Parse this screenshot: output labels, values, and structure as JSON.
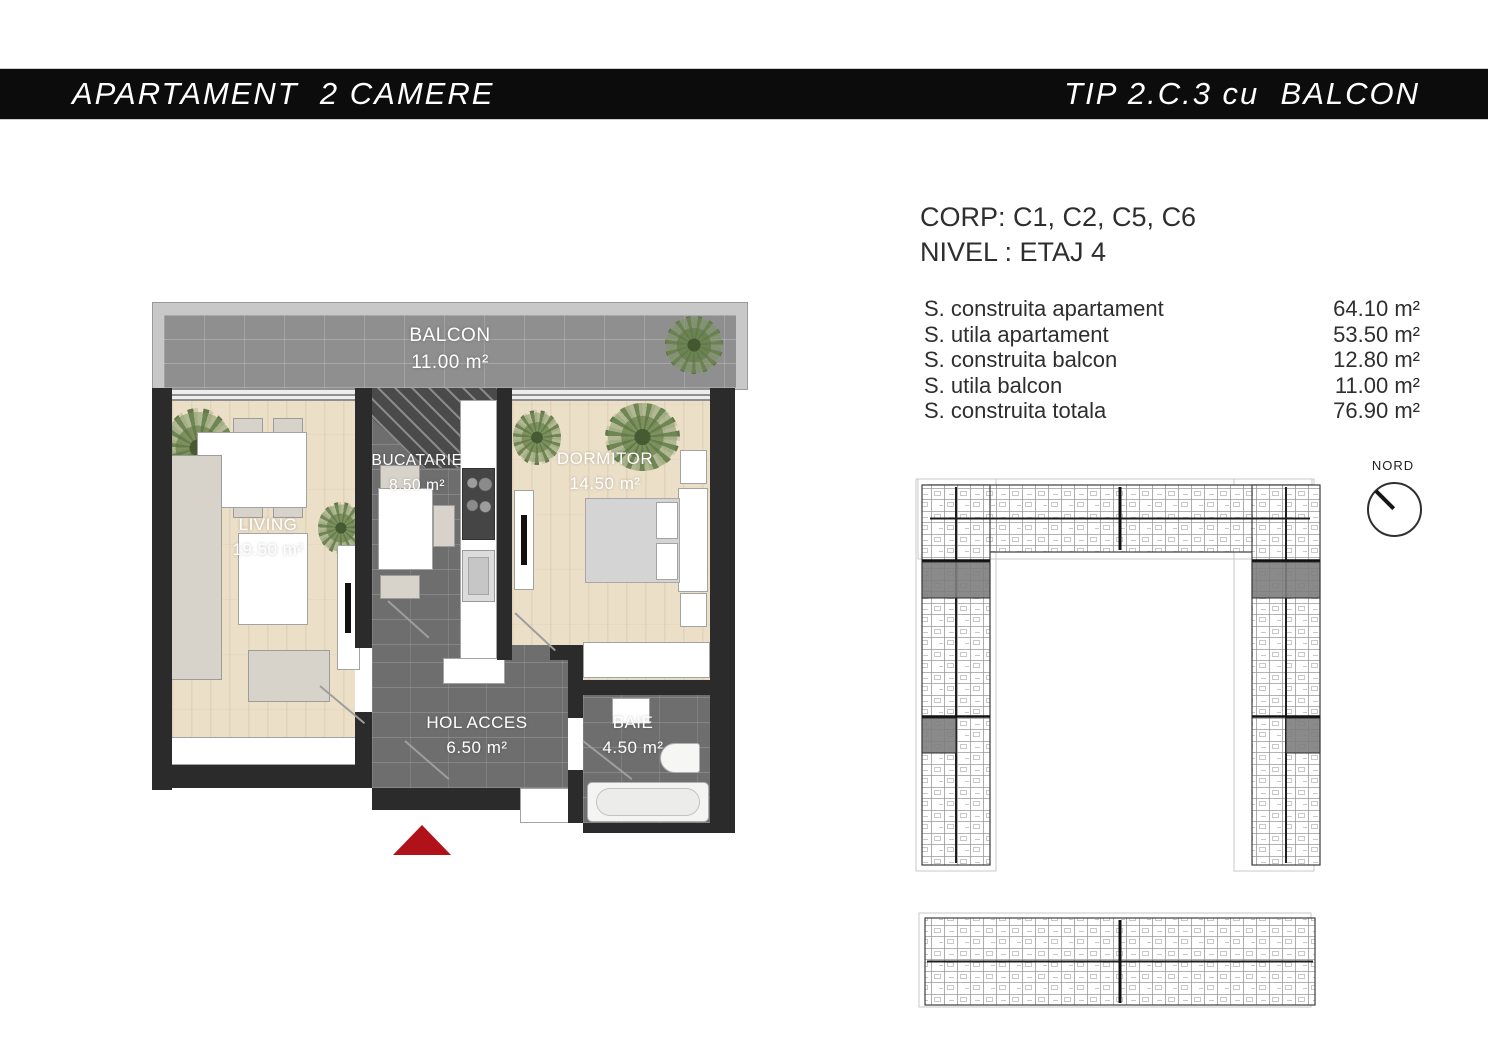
{
  "header": {
    "left_title": "APARTAMENT  2 CAMERE",
    "right_title": "TIP 2.C.3 cu  BALCON"
  },
  "info": {
    "corp": "CORP: C1, C2, C5, C6",
    "nivel": "NIVEL : ETAJ 4"
  },
  "surfaces": {
    "rows": [
      {
        "label": "S. construita apartament",
        "value": "64.10 m²"
      },
      {
        "label": "S. utila apartament",
        "value": "53.50 m²"
      },
      {
        "label": "S. construita balcon",
        "value": "12.80 m²"
      },
      {
        "label": "S. utila balcon",
        "value": "11.00 m²"
      },
      {
        "label": "S. construita totala",
        "value": "76.90 m²"
      }
    ]
  },
  "plan": {
    "rooms": [
      {
        "name": "BALCON",
        "area": "11.00 m²"
      },
      {
        "name": "LIVING",
        "area": "19.50 m²"
      },
      {
        "name": "BUCATARIE",
        "area": "8.50 m²"
      },
      {
        "name": "DORMITOR",
        "area": "14.50 m²"
      },
      {
        "name": "HOL ACCES",
        "area": "6.50 m²"
      },
      {
        "name": "BAIE",
        "area": "4.50 m²"
      }
    ]
  },
  "compass": {
    "label": "NORD"
  },
  "icons": {
    "entrance_marker": "red-triangle-up",
    "compass_needle": "line-pointing-northwest",
    "plants": "green-starburst-plant"
  },
  "colors": {
    "accent_red": "#b1121a",
    "wall": "#2b2b2b",
    "wood_floor": "#ecdfc8",
    "dark_tile": "#6e6e6e",
    "balcony_tile": "#8f8f8f",
    "highlight_unit": "#7d7d7d",
    "header_bg": "#0c0c0c"
  }
}
